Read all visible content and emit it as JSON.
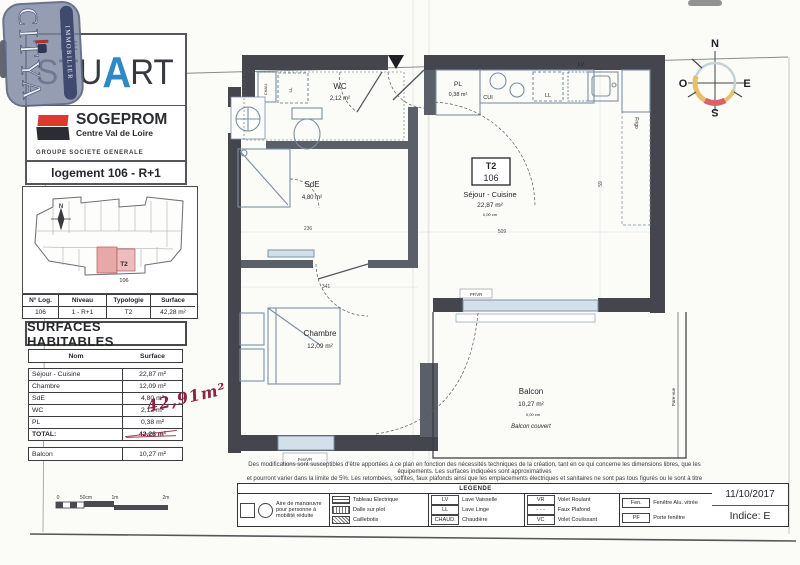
{
  "stamp": {
    "brand": "CITYA",
    "sub": "IMMOBILIER"
  },
  "branding": {
    "project_article": "LE",
    "project_name_pre": "STU",
    "project_name_accent": "A",
    "project_name_post": "RT",
    "developer": "SOGEPROM",
    "developer_region": "Centre Val de Loire",
    "developer_group": "GROUPE SOCIETE GENERALE"
  },
  "header": {
    "title": "logement 106 - R+1"
  },
  "site_plan": {
    "unit_type": "T2",
    "unit_number": "106",
    "north": "N"
  },
  "unit_table": {
    "headers": [
      "N° Log.",
      "Niveau",
      "Typologie",
      "Surface"
    ],
    "row": [
      "106",
      "1 - R+1",
      "T2",
      "42,28 m²"
    ]
  },
  "surfaces": {
    "title": "SURFACES HABITABLES",
    "headers": [
      "Nom",
      "Surface"
    ],
    "rows": [
      {
        "name": "Séjour - Cuisine",
        "area": "22,87 m²"
      },
      {
        "name": "Chambre",
        "area": "12,09 m²"
      },
      {
        "name": "SdE",
        "area": "4,80 m²"
      },
      {
        "name": "WC",
        "area": "2,12 m²"
      },
      {
        "name": "PL",
        "area": "0,38 m²"
      }
    ],
    "total_label": "TOTAL:",
    "total_value": "42,28 m²",
    "handwritten_correction": "42,91m²",
    "balcony_name": "Balcon",
    "balcony_area": "10,27 m²"
  },
  "plan": {
    "unit_box": {
      "type": "T2",
      "number": "106"
    },
    "wc_name": "WC",
    "wc_area": "2,12 m²",
    "sde_name": "SdE",
    "sde_area": "4,80 m²",
    "pl_name": "PL",
    "pl_area": "0,38 m²",
    "sejour_name": "Séjour - Cuisine",
    "sejour_area": "22,87 m²",
    "sejour_height": "0,00 cm",
    "chambre_name": "Chambre",
    "chambre_area": "12,09 m²",
    "balcon_name": "Balcon",
    "balcon_area": "10,27 m²",
    "balcon_height": "0,00 cm",
    "balcon_note": "Balcon couvert",
    "equip_cui": "CUI",
    "equip_ll": "LL",
    "equip_lv": "LV",
    "equip_chau": "CHAU.",
    "equip_frigo": "Frigo",
    "open_fen": "Fen/VR",
    "open_pf": "PF/VR",
    "pare_vue": "Pare-vue",
    "dim_236": "236",
    "dim_341": "341",
    "dim_509": "509",
    "dim_59": "59"
  },
  "compass": {
    "n": "N",
    "e": "E",
    "s": "S",
    "o": "O"
  },
  "scale_bar": {
    "labels": [
      "0",
      "50cm",
      "1m",
      "2m"
    ]
  },
  "disclaimer": {
    "line1": "Des modifications sont susceptibles d'être apportées à ce plan en fonction des nécessités techniques de la création, tant en ce qui concerne les dimensions libres, que les équipements. Les surfaces indiquées sont approximatives",
    "line2": "et pourront varier dans la limite de 5%. Les retombées, soffites, faux plafonds ainsi que les emplacements électriques et sanitaires ne sont pas tous figurés ou le sont à titre indicatif."
  },
  "legend": {
    "title": "LEGENDE",
    "pmr": "Aire de manœuvre pour personne à mobilité réduite",
    "col2": [
      {
        "label": "Tableau Electrique"
      },
      {
        "label": "Dalle sur plot"
      },
      {
        "label": "Caillebotis"
      }
    ],
    "col3": [
      {
        "abbr": "LV",
        "label": "Lave Vaisselle"
      },
      {
        "abbr": "LL",
        "label": "Lave Linge"
      },
      {
        "abbr": "CHAUD.",
        "label": "Chaudière"
      }
    ],
    "col4": [
      {
        "abbr": "VR",
        "label": "Volet Roulant"
      },
      {
        "abbr": "- - -",
        "label": "Faux Plafond"
      },
      {
        "abbr": "VC",
        "label": "Volet Coulissant"
      }
    ],
    "col5": [
      {
        "abbr": "Fen.",
        "label": "Fenêtre Alu. vitrée"
      },
      {
        "abbr": "PF",
        "label": "Porte fenêtre"
      }
    ]
  },
  "footer": {
    "date": "11/10/2017",
    "indice": "Indice: E"
  },
  "colors": {
    "accent_blue": "#2f89c5",
    "sogeprom_red": "#dd3a2e",
    "stamp_blue": "#7e88a2",
    "highlight_pink": "#e9a8a8",
    "handwriting_red": "#8e2340",
    "wall_dark": "#45454e",
    "fixture_blue": "#7b90a5",
    "compass_red": "#d96468",
    "compass_yellow": "#e6c06a"
  }
}
